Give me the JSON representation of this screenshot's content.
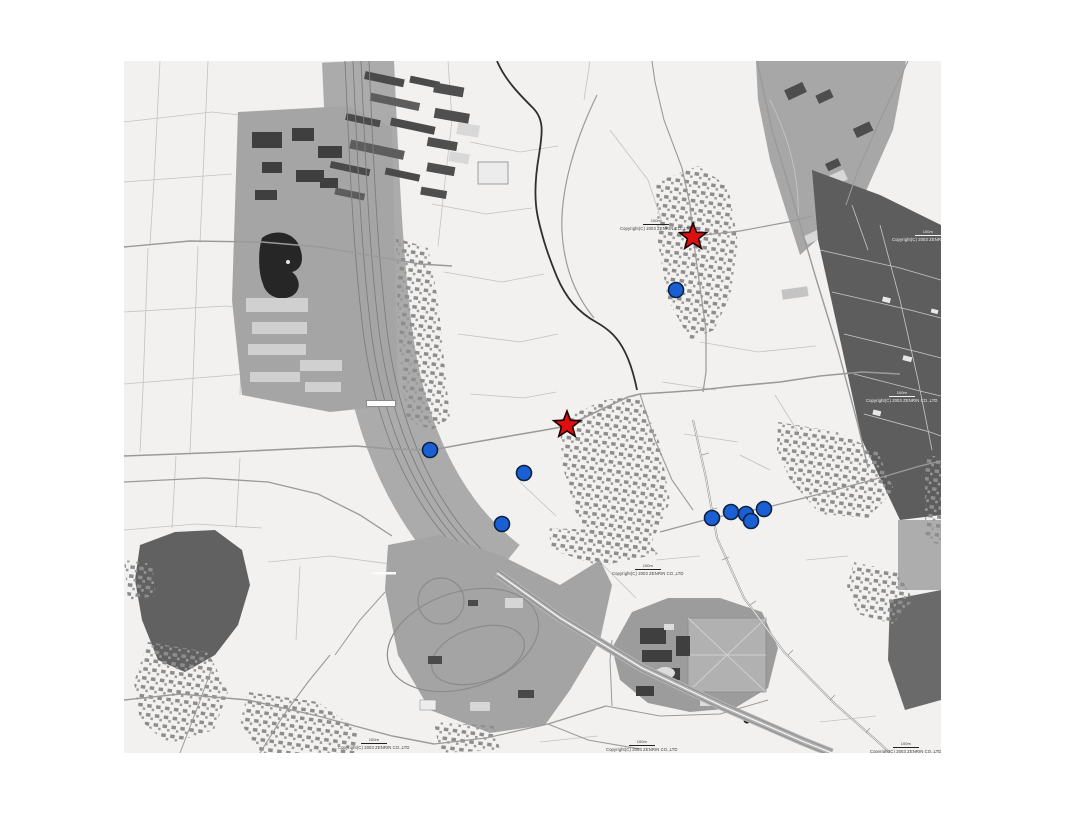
{
  "page": {
    "background": "#ffffff"
  },
  "map": {
    "description": "grayscale-street-map",
    "colors": {
      "map_background": "#f2f1ef",
      "road": "#9a9a9a",
      "parcel_line": "#c2c2c2",
      "urban_gray": "#a5a5a5",
      "dark_field": "#5d5d5d",
      "forest_dark": "#616161",
      "pond": "#262626",
      "river": "#2f2f2f"
    },
    "markers": {
      "star_color": "#e00f0f",
      "star_outline": "#1a0000",
      "star_radius": 14,
      "stars": [
        {
          "x": 693,
          "y": 237
        },
        {
          "x": 567,
          "y": 425
        }
      ],
      "dot_color": "#1a5fd4",
      "dot_outline": "#0c2340",
      "dot_radius": 7.5,
      "dots": [
        {
          "x": 676,
          "y": 290
        },
        {
          "x": 430,
          "y": 450
        },
        {
          "x": 524,
          "y": 473
        },
        {
          "x": 502,
          "y": 524
        },
        {
          "x": 712,
          "y": 518
        },
        {
          "x": 731,
          "y": 512
        },
        {
          "x": 746,
          "y": 514
        },
        {
          "x": 751,
          "y": 521
        },
        {
          "x": 764,
          "y": 509
        }
      ]
    }
  },
  "attribution": {
    "text": "Copyright(C) 2003 ZENRIN CO.,LTD",
    "scale_label": "100m"
  }
}
